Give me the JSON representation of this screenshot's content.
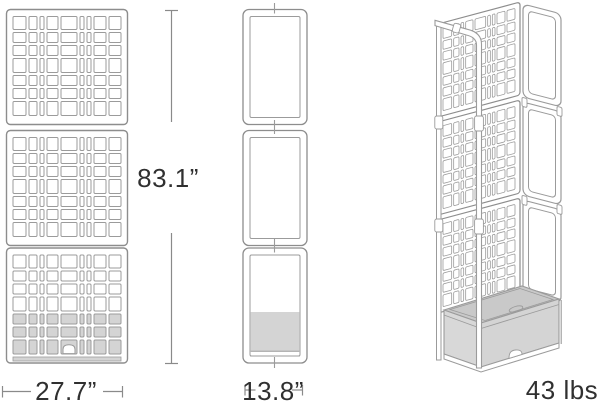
{
  "diagram": {
    "kind": "product-dimension-drawing",
    "product": "lattice-trellis-planter",
    "views": [
      {
        "id": "front-view",
        "dimension": "height-and-width"
      },
      {
        "id": "side-view",
        "dimension": "depth"
      },
      {
        "id": "perspective-view",
        "dimension": "weight"
      }
    ]
  },
  "labels": {
    "height": "83.1”",
    "width": "27.7”",
    "depth": "13.8”",
    "weight": "43 lbs"
  },
  "colors": {
    "background": "#ffffff",
    "outline": "#9b9b9b",
    "panel_border": "#8d8d8d",
    "dimension_line": "#8a8a8a",
    "text": "#303030",
    "planter_fill": "#d4d4d4",
    "planter_top_fill": "#c9c9c9",
    "planter_side_fill": "#d8d8d8"
  },
  "lattice": {
    "columns": [
      13,
      8,
      4,
      11,
      16,
      4,
      4,
      12,
      12
    ],
    "rows": [
      13,
      10,
      10,
      14,
      10,
      10,
      14
    ],
    "gap": 3,
    "panel_count": 3,
    "gray_row_start_index": 4
  }
}
